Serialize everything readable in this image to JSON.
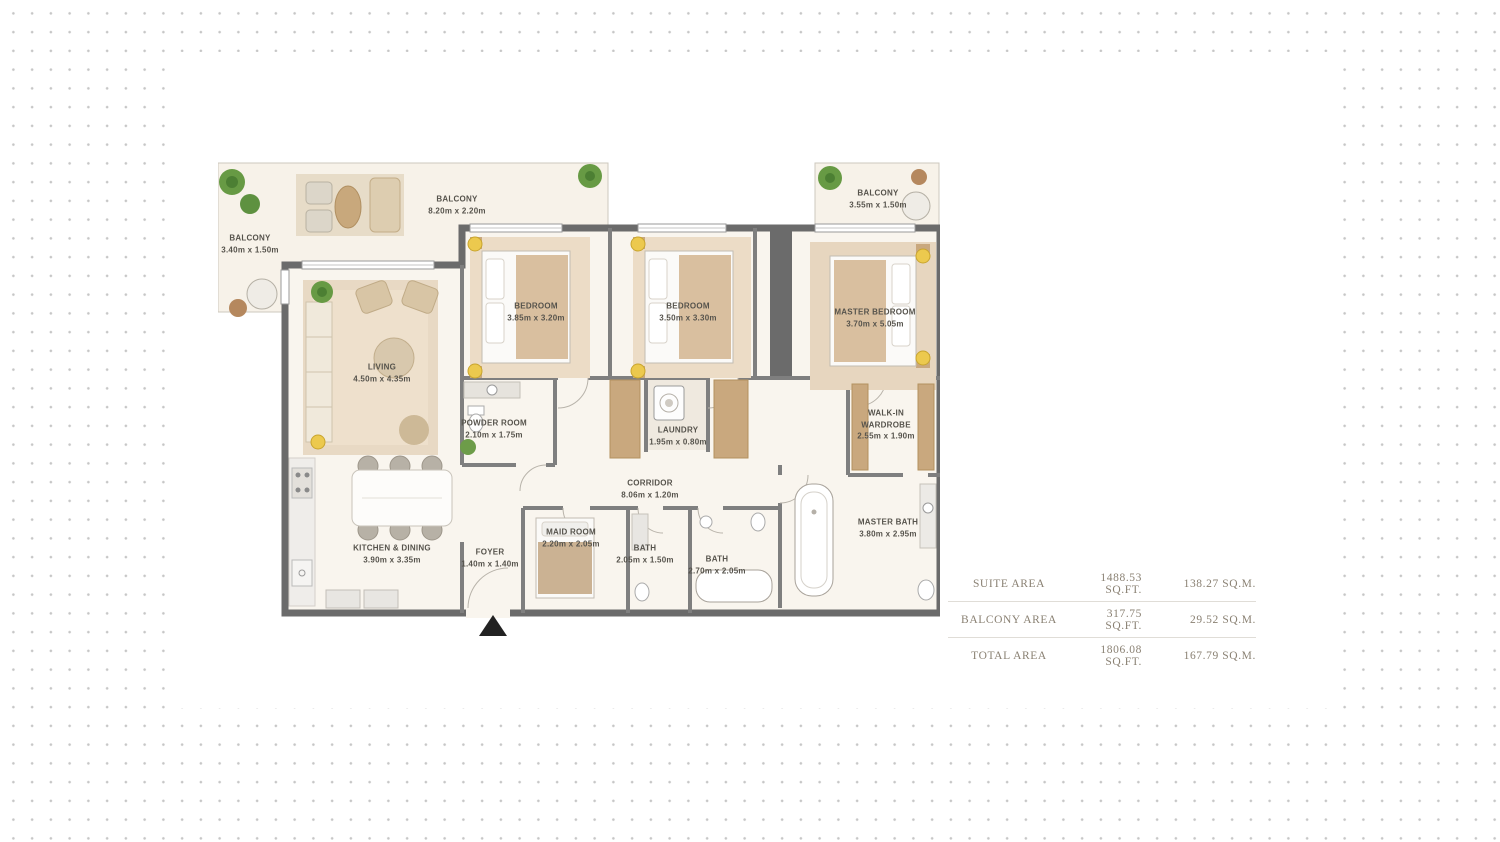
{
  "floorplan": {
    "rooms": [
      {
        "id": "balcony-left",
        "name": "BALCONY",
        "dims": "3.40m x 1.50m"
      },
      {
        "id": "balcony-top",
        "name": "BALCONY",
        "dims": "8.20m x 2.20m"
      },
      {
        "id": "balcony-right",
        "name": "BALCONY",
        "dims": "3.55m x 1.50m"
      },
      {
        "id": "bedroom-1",
        "name": "BEDROOM",
        "dims": "3.85m x 3.20m"
      },
      {
        "id": "bedroom-2",
        "name": "BEDROOM",
        "dims": "3.50m x 3.30m"
      },
      {
        "id": "master-bedroom",
        "name": "MASTER BEDROOM",
        "dims": "3.70m x 5.05m"
      },
      {
        "id": "living",
        "name": "LIVING",
        "dims": "4.50m x 4.35m"
      },
      {
        "id": "powder-room",
        "name": "POWDER ROOM",
        "dims": "2.10m x 1.75m"
      },
      {
        "id": "laundry",
        "name": "LAUNDRY",
        "dims": "1.95m x 0.80m"
      },
      {
        "id": "walk-in-wardrobe",
        "name": "WALK-IN WARDROBE",
        "dims": "2.55m x 1.90m"
      },
      {
        "id": "corridor",
        "name": "CORRIDOR",
        "dims": "8.06m x 1.20m"
      },
      {
        "id": "kitchen-dining",
        "name": "KITCHEN & DINING",
        "dims": "3.90m x 3.35m"
      },
      {
        "id": "foyer",
        "name": "FOYER",
        "dims": "1.40m x 1.40m"
      },
      {
        "id": "maid-room",
        "name": "MAID ROOM",
        "dims": "2.20m x 2.05m"
      },
      {
        "id": "bath-1",
        "name": "BATH",
        "dims": "2.05m x 1.50m"
      },
      {
        "id": "bath-2",
        "name": "BATH",
        "dims": "2.70m x 2.05m"
      },
      {
        "id": "master-bath",
        "name": "MASTER BATH",
        "dims": "3.80m x 2.95m"
      }
    ]
  },
  "area_table": {
    "rows": [
      {
        "label": "SUITE AREA",
        "sqft": "1488.53 SQ.FT.",
        "sqm": "138.27 SQ.M."
      },
      {
        "label": "BALCONY AREA",
        "sqft": "317.75 SQ.FT.",
        "sqm": "29.52 SQ.M."
      },
      {
        "label": "TOTAL AREA",
        "sqft": "1806.08 SQ.FT.",
        "sqm": "167.79 SQ.M."
      }
    ]
  },
  "colors": {
    "wall": "#6b6b6b",
    "floor": "#f9f5ee",
    "closet_tan": "#c9a87e",
    "plant_green": "#679a44",
    "lamp_yellow": "#ecc94e",
    "label_text": "#56534c",
    "table_text": "#8a8173",
    "dot_pattern": "#c6c6c6"
  }
}
